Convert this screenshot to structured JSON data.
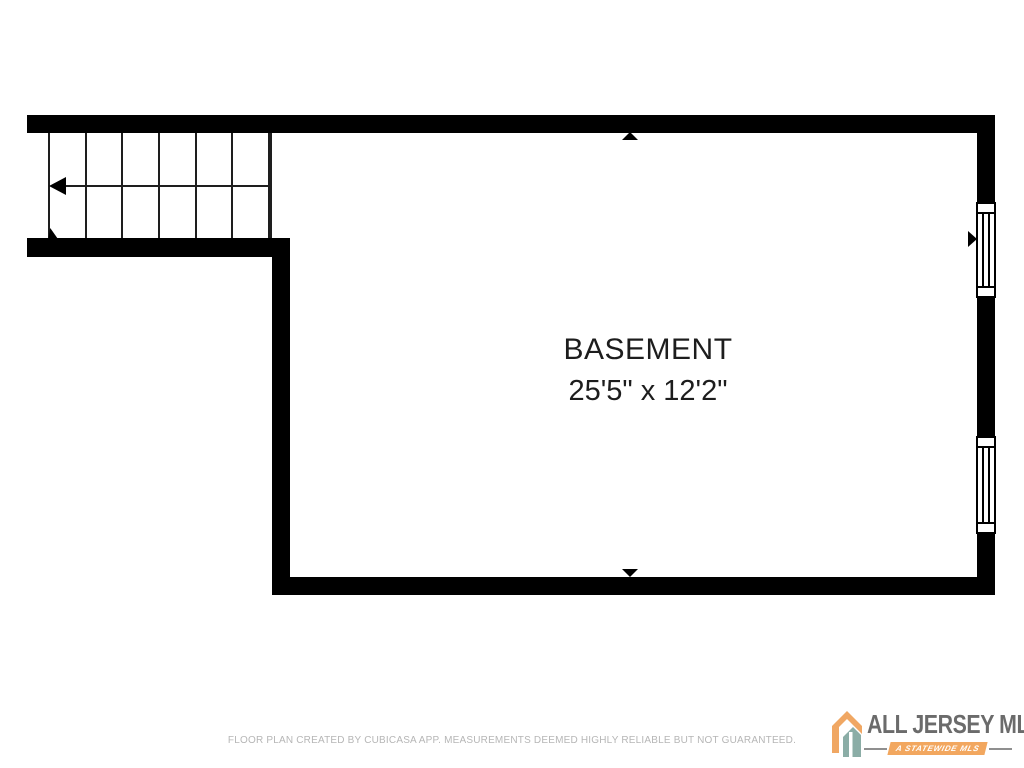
{
  "floor_plan": {
    "room_label": "BASEMENT",
    "room_dimensions": "25'5\" x 12'2\"",
    "wall_color": "#000000",
    "staircase": {
      "steps": 6,
      "direction": "left"
    },
    "windows": [
      "window-upper-right",
      "window-lower-right"
    ],
    "markers": [
      "arrow-up-top-wall",
      "arrow-down-bottom-wall",
      "arrow-right-right-wall"
    ]
  },
  "footer": {
    "disclaimer": "FLOOR PLAN CREATED BY CUBICASA APP. MEASUREMENTS DEEMED HIGHLY RELIABLE BUT NOT GUARANTEED."
  },
  "logo": {
    "name": "ALL JERSEY MLS",
    "tagline": "A STATEWIDE MLS",
    "orange": "#f2a75f",
    "teal": "#8badа6",
    "text_color": "#6b6b6b"
  }
}
